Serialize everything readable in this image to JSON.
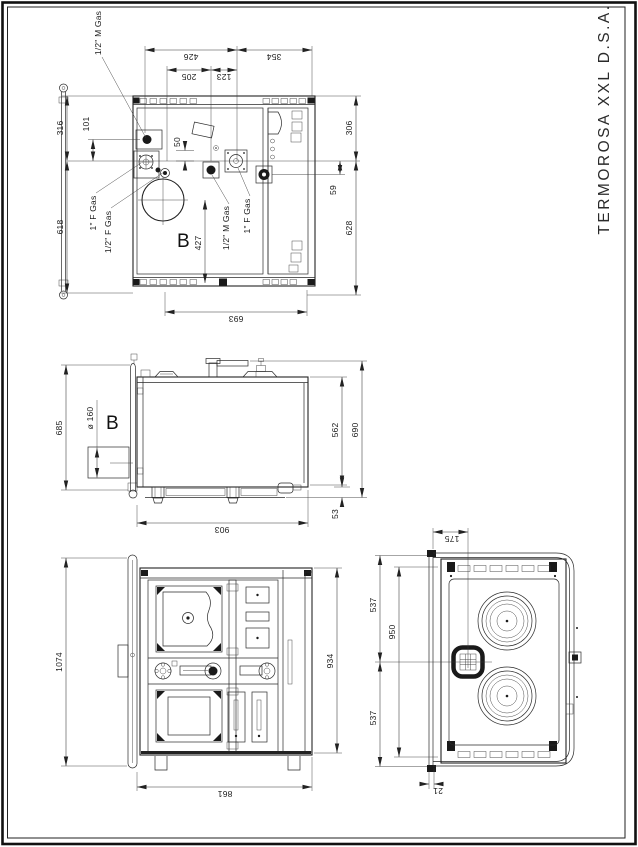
{
  "sheet": {
    "title": "TERMOROSA XXL D.S.A."
  },
  "views": {
    "rear": {
      "label": "B",
      "dims": {
        "w426": "426",
        "w205": "205",
        "w123": "123",
        "w354": "354",
        "h316": "316",
        "h101": "101",
        "h618": "618",
        "h306": "306",
        "h59": "59",
        "h628": "628",
        "w693": "693",
        "o50": "50",
        "o427": "427"
      },
      "ports": {
        "top_gas": "1/2\" M Gas",
        "left_gas_1": "1\" F Gas",
        "left_gas_2": "1/2\" F Gas",
        "mid_gas": "1/2\" M Gas",
        "right_gas": "1\" F Gas"
      }
    },
    "side": {
      "label": "B",
      "dims": {
        "h685": "685",
        "flue": "ø 160",
        "h562": "562",
        "h690": "690",
        "h53": "53",
        "w903": "903"
      }
    },
    "front": {
      "dims": {
        "h1074": "1074",
        "h934": "934",
        "w861": "861"
      }
    },
    "top": {
      "dims": {
        "w175": "175",
        "h537a": "537",
        "h950": "950",
        "h537b": "537",
        "w21": "21"
      }
    }
  }
}
